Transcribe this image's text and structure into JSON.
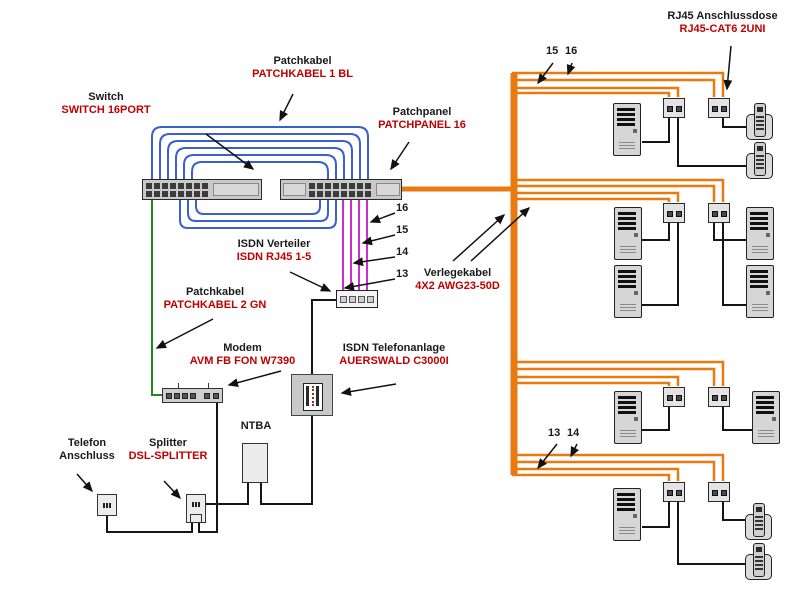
{
  "labels": {
    "switch": {
      "name": "Switch",
      "product": "SWITCH 16PORT"
    },
    "patchkabel1": {
      "name": "Patchkabel",
      "product": "PATCHKABEL 1 BL"
    },
    "patchpanel": {
      "name": "Patchpanel",
      "product": "PATCHPANEL 16"
    },
    "rj45dose": {
      "name": "RJ45 Anschlussdose",
      "product": "RJ45-CAT6 2UNI"
    },
    "isdnverteiler": {
      "name": "ISDN Verteiler",
      "product": "ISDN RJ45 1-5"
    },
    "verlegekabel": {
      "name": "Verlegekabel",
      "product": "4X2 AWG23-50D"
    },
    "patchkabel2": {
      "name": "Patchkabel",
      "product": "PATCHKABEL 2 GN"
    },
    "modem": {
      "name": "Modem",
      "product": "AVM FB FON W7390"
    },
    "anlage": {
      "name": "ISDN Telefonanlage",
      "product": "AUERSWALD C3000I"
    },
    "telefon": {
      "name": "Telefon Anschluss"
    },
    "splitter": {
      "name": "Splitter",
      "product": "DSL-SPLITTER"
    },
    "ntba": {
      "name": "NTBA"
    }
  },
  "cable_numbers": {
    "patchpanel_ports": [
      "16",
      "15",
      "14",
      "13"
    ],
    "top_run": [
      "15",
      "16"
    ],
    "bottom_run": [
      "13",
      "14"
    ]
  },
  "colors": {
    "patchkabel_blue": "#3a5fd0",
    "patchkabel_green": "#1e8a1e",
    "isdn_magenta": "#cc2ecc",
    "verlegekabel_orange": "#e87a10",
    "label_red": "#c00000",
    "label_black": "#1a1a1a"
  },
  "icons": {
    "computer": "tower-pc-icon",
    "phone": "desk-phone-icon",
    "outlet": "rj45-wall-outlet-icon"
  },
  "right_side_groups": [
    {
      "outlets": 2,
      "computers": 1,
      "phones": 2
    },
    {
      "outlets": 2,
      "computers": 4,
      "phones": 0
    },
    {
      "outlets": 2,
      "computers": 2,
      "phones": 0
    },
    {
      "outlets": 2,
      "computers": 1,
      "phones": 2
    }
  ]
}
